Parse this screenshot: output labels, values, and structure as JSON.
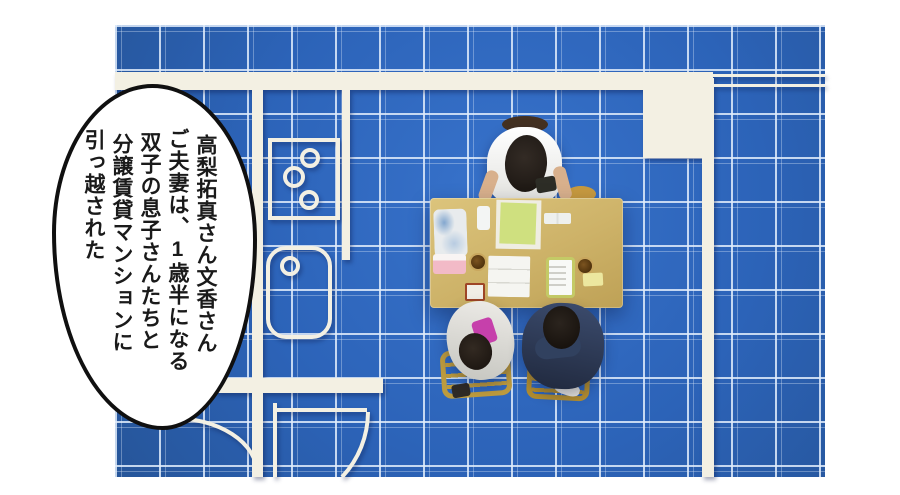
{
  "bubble": {
    "lines": [
      "高梨拓真さん文香さん",
      "ご夫妻は、1歳半になる",
      "双子の息子さんたちと",
      "分譲賃貸マンションに",
      "引っ越された"
    ],
    "fill": "#ffffff",
    "border_color": "#101010",
    "text_color": "#1a1a1a"
  },
  "blueprint": {
    "blue": "#2c63b8",
    "grid_line": "#e0ecfb",
    "wall_color": "#f3f0e3",
    "fixtures": [
      "top-wall",
      "balcony-square",
      "right-wall",
      "left-wall",
      "kitchen-divider",
      "stove-three-burners",
      "bathtub",
      "bottom-wall",
      "door-swing-arcs"
    ]
  },
  "photo": {
    "objects": [
      "meeting-table",
      "father-top-seat",
      "plastic-bag",
      "white-phone",
      "green-booklet",
      "white-sheet",
      "paper-cards",
      "tissue-box",
      "tea-cup-1",
      "trifold-document",
      "tablet-device",
      "tea-cup-2",
      "yellow-card",
      "red-stamp-box",
      "mother-left",
      "agent-right",
      "wooden-chairs"
    ],
    "colors": {
      "table_wood": "#cdb268",
      "chair_wood": "#bd9b3e",
      "navy_jacket": "#2a3750",
      "cardigan_gray": "#d8d8d3",
      "hair_black": "#1d1815",
      "skin": "#d8b08c",
      "pink_item": "#c640ab",
      "tissue_pink": "#f2bac7",
      "booklet_green": "#cfe07f",
      "tablet_frame": "#c4ca66",
      "card_yellow": "#ece79f",
      "box_red_brown": "#9e4526",
      "cup_brown": "#5d3d15",
      "stool_brown": "#443122"
    }
  }
}
